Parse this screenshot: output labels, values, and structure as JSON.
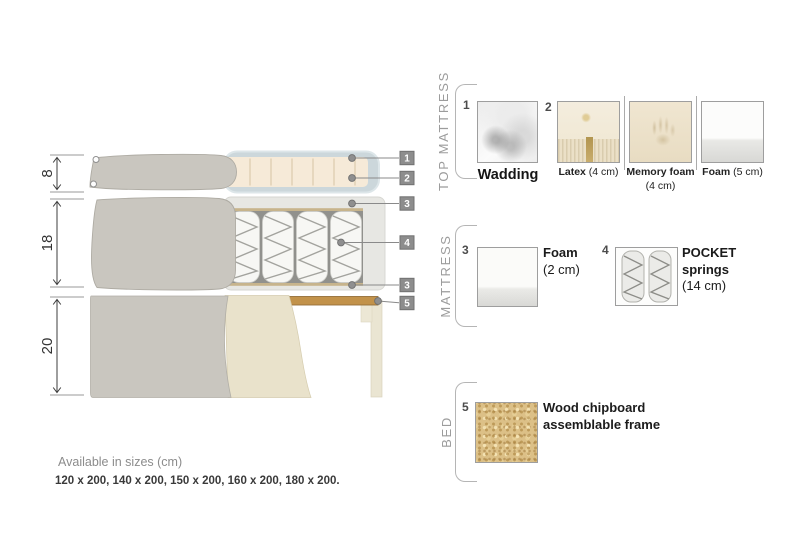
{
  "diagram": {
    "dimensions": [
      {
        "label": "8"
      },
      {
        "label": "18"
      },
      {
        "label": "20"
      }
    ],
    "callouts": [
      {
        "number": "1"
      },
      {
        "number": "2"
      },
      {
        "number": "3"
      },
      {
        "number": "4"
      },
      {
        "number": "3"
      },
      {
        "number": "5"
      }
    ]
  },
  "legend": {
    "groups": [
      {
        "title": "TOP MATTRESS"
      },
      {
        "title": "MATTRESS"
      },
      {
        "title": "BED"
      }
    ],
    "items": {
      "wadding": {
        "number": "1",
        "name": "Wadding",
        "size": ""
      },
      "latex": {
        "number": "2",
        "name": "Latex",
        "size": " (4 cm)"
      },
      "memory_foam": {
        "name": "Memory foam",
        "size": " (4 cm)"
      },
      "foam5": {
        "name": "Foam",
        "size": " (5 cm)"
      },
      "foam2": {
        "number": "3",
        "name": "Foam",
        "size": "(2 cm)"
      },
      "pocket_springs": {
        "number": "4",
        "name": "POCKET springs",
        "size": "(14 cm)"
      },
      "chipboard": {
        "number": "5",
        "name": "Wood chipboard assemblable frame",
        "size": ""
      }
    }
  },
  "footer": {
    "sizes_title": "Available in sizes (cm)",
    "sizes_list": "120 x 200, 140 x 200, 150 x 200, 160 x 200, 180 x 200."
  },
  "colors": {
    "fabric_gray": "#c9c6bf",
    "latex_cream": "#f6ead8",
    "wadding_blue": "#ccd7db",
    "foam_casing": "#e7e7e3",
    "spring_white": "#f7f7f4",
    "tan_tape": "#c7b48c",
    "wood_slat": "#c2924a",
    "frame_beige": "#eae5d2",
    "drape_beige": "#e9e2cb",
    "callout_gray": "#8d8d8d"
  }
}
